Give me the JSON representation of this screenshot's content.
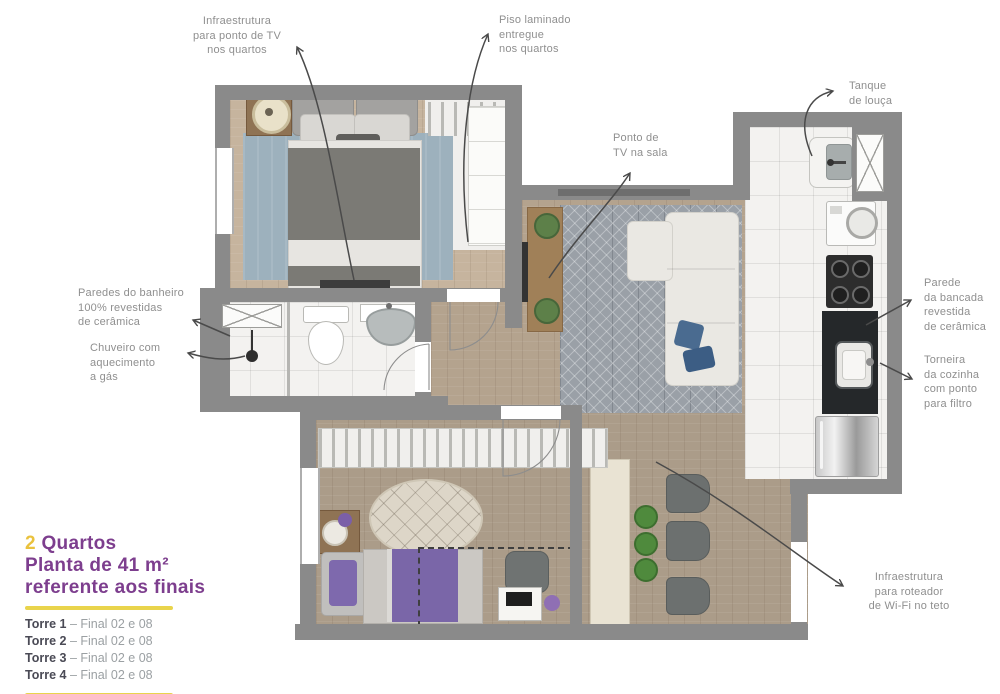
{
  "annotations": {
    "infra_tv": "Infraestrutura\npara ponto de TV\nnos quartos",
    "piso_laminado": "Piso laminado\nentregue\nnos quartos",
    "tanque": "Tanque\nde louça",
    "ponto_tv_sala": "Ponto de\nTV na sala",
    "paredes_banheiro": "Paredes do banheiro\n100% revestidas\nde cerâmica",
    "chuveiro": "Chuveiro com\naquecimento\na gás",
    "parede_bancada": "Parede\nda bancada\nrevestida\nde cerâmica",
    "torneira": "Torneira\nda cozinha\ncom ponto\npara filtro",
    "roteador": "Infraestrutura\npara roteador\nde Wi-Fi no teto"
  },
  "legend": {
    "count": "2",
    "count_label": "Quartos",
    "line2": "Planta de 41 m²",
    "line3": "referente aos finais",
    "towers": [
      {
        "name": "Torre 1",
        "detail": "– Final 02 e 08"
      },
      {
        "name": "Torre 2",
        "detail": "– Final 02 e 08"
      },
      {
        "name": "Torre 3",
        "detail": "– Final 02 e 08"
      },
      {
        "name": "Torre 4",
        "detail": "– Final 02 e 08"
      }
    ]
  },
  "colors": {
    "wall": "#8a8a8a",
    "label_text": "#8f8f8f",
    "accent_purple": "#7d3e8e",
    "accent_yellow": "#e9d44c",
    "arrow": "#4a4a4a"
  }
}
